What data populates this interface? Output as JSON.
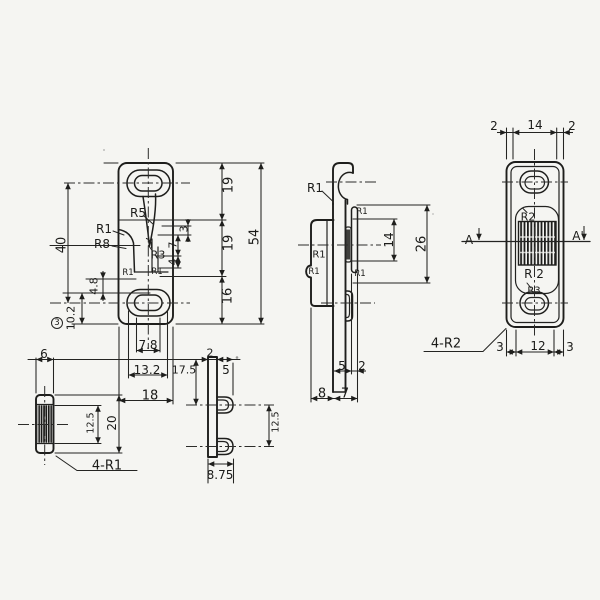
{
  "background": "#f5f5f2",
  "ink": "#1e1e1c",
  "front_view": {
    "radii": {
      "r5": "R5",
      "r1_upper": "R1",
      "r8": "R8",
      "r3": "R3",
      "r1_step_left": "R1",
      "r1_step_right": "R1"
    },
    "dims": {
      "d40": "40",
      "d4_8": "4.8",
      "d10_2": "10.2",
      "balloon": "3",
      "d3": "3",
      "d7": "7",
      "d4": "4",
      "d19_top": "19",
      "d19_mid": "19",
      "d16": "16",
      "d54": "54",
      "d7_8": "7.8",
      "d13_2": "13.2",
      "d18": "18"
    }
  },
  "side_view": {
    "radii": {
      "r1_hook": "R1",
      "r1_tab": "R1",
      "r1_mid": "R1",
      "r1_notch": "R1",
      "r1_slot": "R1"
    },
    "dims": {
      "d14": "14",
      "d26": "26",
      "d5": "5",
      "d2": "2",
      "d8": "8",
      "d7": "7"
    }
  },
  "back_view": {
    "dims": {
      "d2_left": "2",
      "d14": "14",
      "d2_right": "2",
      "d3_left": "3",
      "d12": "12",
      "d3_right": "3"
    },
    "radii": {
      "r2_top": "R2",
      "r2_bottom": "R 2",
      "r3": "R3"
    },
    "section": {
      "left": "A",
      "right": "A'"
    },
    "note": "4-R2"
  },
  "edge_view": {
    "dims": {
      "d6": "6",
      "d20": "20",
      "d12_5": "12.5"
    },
    "note": "4-R1"
  },
  "section_view": {
    "dims": {
      "d2": "2",
      "d5": "5",
      "d17_5": "17.5",
      "d12_5": "12.5",
      "d8_75": "8.75"
    }
  }
}
